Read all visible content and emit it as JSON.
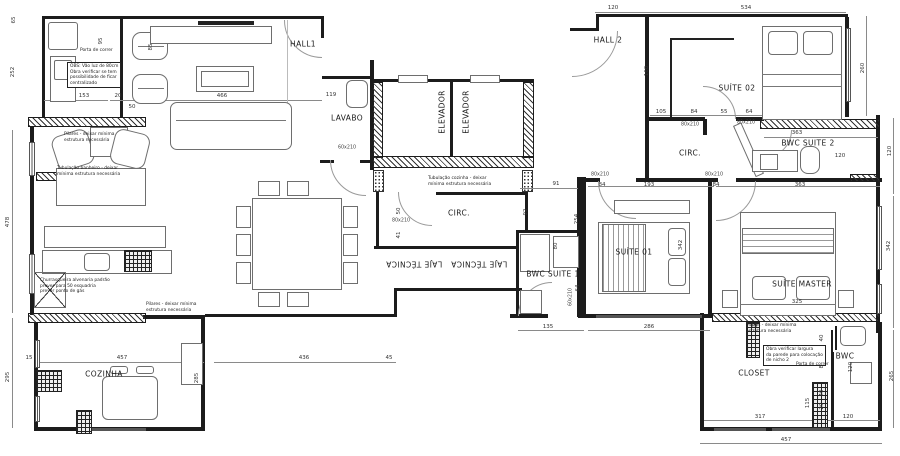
{
  "colors": {
    "wall": "#1c1c1c",
    "furniture": "#6e6e6e",
    "dimension": "#333333",
    "paper": "#ffffff"
  },
  "rooms": [
    {
      "label": "HALL1",
      "x": 303,
      "y": 44,
      "r": 0
    },
    {
      "label": "HALL 2",
      "x": 608,
      "y": 40,
      "r": 0
    },
    {
      "label": "LAVABO",
      "x": 347,
      "y": 118,
      "r": 0
    },
    {
      "label": "ELEVADOR",
      "x": 442,
      "y": 112,
      "r": -90
    },
    {
      "label": "ELEVADOR",
      "x": 466,
      "y": 112,
      "r": -90
    },
    {
      "label": "SUÍTE 02",
      "x": 737,
      "y": 88,
      "r": 0
    },
    {
      "label": "CIRC.",
      "x": 690,
      "y": 153,
      "r": 0
    },
    {
      "label": "BWC SUITE 2",
      "x": 808,
      "y": 143,
      "r": 0
    },
    {
      "label": "CIRC.",
      "x": 459,
      "y": 213,
      "r": 0
    },
    {
      "label": "LAJE TÉCNICA",
      "x": 414,
      "y": 264,
      "r": 180
    },
    {
      "label": "LAJE TÉCNICA",
      "x": 479,
      "y": 264,
      "r": 180
    },
    {
      "label": "BWC SUITE 1",
      "x": 553,
      "y": 274,
      "r": 0
    },
    {
      "label": "SUÍTE 01",
      "x": 634,
      "y": 252,
      "r": 0
    },
    {
      "label": "SUÍTE MASTER",
      "x": 802,
      "y": 284,
      "r": 0
    },
    {
      "label": "COZINHA",
      "x": 104,
      "y": 374,
      "r": 0
    },
    {
      "label": "CLOSET",
      "x": 754,
      "y": 373,
      "r": 0
    },
    {
      "label": "BWC",
      "x": 845,
      "y": 356,
      "r": 0
    }
  ],
  "dimensions": [
    {
      "t": "65",
      "x": 14,
      "y": 20,
      "r": -90
    },
    {
      "t": "252",
      "x": 13,
      "y": 72,
      "r": -90
    },
    {
      "t": "95",
      "x": 101,
      "y": 41,
      "r": -90
    },
    {
      "t": "85",
      "x": 151,
      "y": 47,
      "r": -90
    },
    {
      "t": "153",
      "x": 84,
      "y": 96,
      "r": 0
    },
    {
      "t": "20",
      "x": 118,
      "y": 96,
      "r": 0
    },
    {
      "t": "50",
      "x": 132,
      "y": 107,
      "r": 0
    },
    {
      "t": "466",
      "x": 222,
      "y": 96,
      "r": 0
    },
    {
      "t": "119",
      "x": 331,
      "y": 95,
      "r": 0
    },
    {
      "t": "478",
      "x": 8,
      "y": 222,
      "r": -90
    },
    {
      "t": "295",
      "x": 8,
      "y": 377,
      "r": -90
    },
    {
      "t": "15",
      "x": 29,
      "y": 358,
      "r": 0
    },
    {
      "t": "457",
      "x": 122,
      "y": 358,
      "r": 0
    },
    {
      "t": "285",
      "x": 197,
      "y": 378,
      "r": -90
    },
    {
      "t": "436",
      "x": 304,
      "y": 358,
      "r": 0
    },
    {
      "t": "45",
      "x": 389,
      "y": 358,
      "r": 0
    },
    {
      "t": "91",
      "x": 556,
      "y": 184,
      "r": 0
    },
    {
      "t": "50",
      "x": 399,
      "y": 211,
      "r": -90
    },
    {
      "t": "41",
      "x": 399,
      "y": 235,
      "r": -90
    },
    {
      "t": "92",
      "x": 526,
      "y": 212,
      "r": -90
    },
    {
      "t": "80",
      "x": 556,
      "y": 246,
      "r": -90
    },
    {
      "t": "64",
      "x": 578,
      "y": 288,
      "r": -90
    },
    {
      "t": "135",
      "x": 548,
      "y": 327,
      "r": 0
    },
    {
      "t": "286",
      "x": 649,
      "y": 327,
      "r": 0
    },
    {
      "t": "254",
      "x": 577,
      "y": 219,
      "r": -90
    },
    {
      "t": "342",
      "x": 681,
      "y": 245,
      "r": -90
    },
    {
      "t": "84",
      "x": 602,
      "y": 185,
      "r": 0
    },
    {
      "t": "193",
      "x": 649,
      "y": 185,
      "r": 0
    },
    {
      "t": "84",
      "x": 716,
      "y": 185,
      "r": 0
    },
    {
      "t": "363",
      "x": 800,
      "y": 185,
      "r": 0
    },
    {
      "t": "120",
      "x": 613,
      "y": 8,
      "r": 0
    },
    {
      "t": "534",
      "x": 746,
      "y": 8,
      "r": 0
    },
    {
      "t": "105",
      "x": 661,
      "y": 112,
      "r": 0
    },
    {
      "t": "84",
      "x": 694,
      "y": 112,
      "r": 0
    },
    {
      "t": "55",
      "x": 724,
      "y": 112,
      "r": 0
    },
    {
      "t": "64",
      "x": 749,
      "y": 112,
      "r": 0
    },
    {
      "t": "160",
      "x": 647,
      "y": 71,
      "r": -90
    },
    {
      "t": "260",
      "x": 863,
      "y": 68,
      "r": -90
    },
    {
      "t": "363",
      "x": 797,
      "y": 133,
      "r": 0
    },
    {
      "t": "120",
      "x": 840,
      "y": 156,
      "r": 0
    },
    {
      "t": "120",
      "x": 890,
      "y": 151,
      "r": -90
    },
    {
      "t": "342",
      "x": 889,
      "y": 246,
      "r": -90
    },
    {
      "t": "265",
      "x": 892,
      "y": 376,
      "r": -90
    },
    {
      "t": "325",
      "x": 797,
      "y": 302,
      "r": 0
    },
    {
      "t": "49",
      "x": 754,
      "y": 326,
      "r": 0
    },
    {
      "t": "40",
      "x": 822,
      "y": 338,
      "r": -90
    },
    {
      "t": "20",
      "x": 822,
      "y": 351,
      "r": -90
    },
    {
      "t": "80",
      "x": 822,
      "y": 365,
      "r": -90
    },
    {
      "t": "40",
      "x": 822,
      "y": 393,
      "r": -90
    },
    {
      "t": "20",
      "x": 822,
      "y": 406,
      "r": -90
    },
    {
      "t": "120",
      "x": 851,
      "y": 367,
      "r": -90
    },
    {
      "t": "115",
      "x": 808,
      "y": 403,
      "r": -90
    },
    {
      "t": "317",
      "x": 760,
      "y": 417,
      "r": 0
    },
    {
      "t": "120",
      "x": 848,
      "y": 417,
      "r": 0
    },
    {
      "t": "457",
      "x": 786,
      "y": 440,
      "r": 0
    }
  ],
  "door_labels": [
    {
      "t": "60x210",
      "x": 347,
      "y": 148,
      "r": 0
    },
    {
      "t": "80x210",
      "x": 401,
      "y": 221,
      "r": 0
    },
    {
      "t": "80x210",
      "x": 690,
      "y": 125,
      "r": 0
    },
    {
      "t": "80x210",
      "x": 746,
      "y": 123,
      "r": 0
    },
    {
      "t": "80x210",
      "x": 600,
      "y": 175,
      "r": 0
    },
    {
      "t": "80x210",
      "x": 714,
      "y": 175,
      "r": 0
    },
    {
      "t": "60x210",
      "x": 571,
      "y": 297,
      "r": -90
    }
  ],
  "notes": [
    {
      "x": 67,
      "y": 62,
      "boxed": true,
      "lines": [
        "OBS: Vão luz de 80cm",
        "Obra verificar se tem",
        "possibilidade de ficar",
        "centralizado"
      ]
    },
    {
      "x": 80,
      "y": 48,
      "boxed": false,
      "lines": [
        "Porta de correr"
      ]
    },
    {
      "x": 64,
      "y": 132,
      "boxed": false,
      "lines": [
        "Pilares - deixar mínima",
        "estrutura necessária"
      ]
    },
    {
      "x": 57,
      "y": 166,
      "boxed": false,
      "lines": [
        "Tubulação banheiro - deixar",
        "mínima estrutura necessária"
      ]
    },
    {
      "x": 428,
      "y": 176,
      "boxed": false,
      "lines": [
        "Tubulação cozinha - deixar",
        "mínima estrutura necessária"
      ]
    },
    {
      "x": 40,
      "y": 278,
      "boxed": false,
      "lines": [
        "Churrasqueira alvenaria padrão",
        "prever para 50 esquadria",
        "prever ponto de gás"
      ]
    },
    {
      "x": 146,
      "y": 302,
      "boxed": false,
      "lines": [
        "Pilares - deixar mínima",
        "estrutura necessária"
      ]
    },
    {
      "x": 746,
      "y": 323,
      "boxed": false,
      "lines": [
        "Pilares - deixar mínima",
        "estrutura necessária"
      ]
    },
    {
      "x": 763,
      "y": 345,
      "boxed": true,
      "lines": [
        "Obra verificar largura",
        "da parede para colocação",
        "de nicho 2"
      ]
    },
    {
      "x": 796,
      "y": 362,
      "boxed": false,
      "lines": [
        "Porta de correr"
      ]
    }
  ]
}
